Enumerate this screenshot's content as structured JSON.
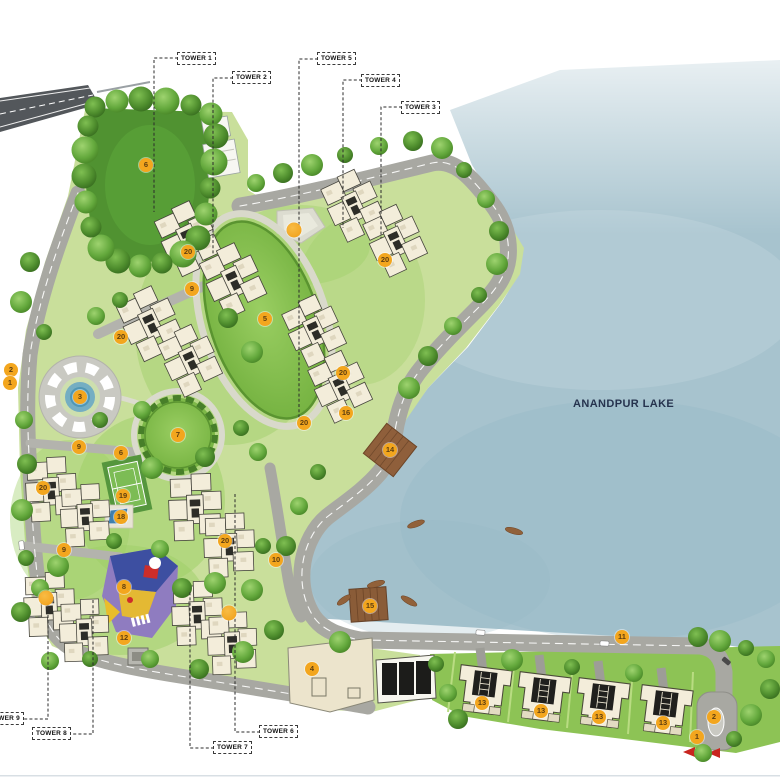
{
  "lake": {
    "name": "ANANDPUR LAKE"
  },
  "tower_labels": [
    {
      "label": "TOWER 1",
      "x": 177,
      "y": 52,
      "leader": [
        [
          178,
          58
        ],
        [
          154,
          58
        ],
        [
          154,
          212
        ]
      ]
    },
    {
      "label": "TOWER 2",
      "x": 232,
      "y": 71,
      "leader": [
        [
          233,
          78
        ],
        [
          213,
          78
        ],
        [
          213,
          255
        ]
      ]
    },
    {
      "label": "TOWER 5",
      "x": 317,
      "y": 52,
      "leader": [
        [
          318,
          59
        ],
        [
          299,
          59
        ],
        [
          299,
          425
        ]
      ]
    },
    {
      "label": "TOWER 4",
      "x": 361,
      "y": 74,
      "leader": [
        [
          362,
          80
        ],
        [
          343,
          80
        ],
        [
          343,
          228
        ]
      ]
    },
    {
      "label": "TOWER 3",
      "x": 401,
      "y": 101,
      "leader": [
        [
          402,
          107
        ],
        [
          381,
          107
        ],
        [
          381,
          238
        ]
      ]
    },
    {
      "label": "TOWER 9",
      "x": -15,
      "y": 712,
      "leader": [
        [
          19,
          719
        ],
        [
          48,
          719
        ],
        [
          48,
          592
        ]
      ]
    },
    {
      "label": "TOWER 8",
      "x": 32,
      "y": 727,
      "leader": [
        [
          68,
          734
        ],
        [
          93,
          734
        ],
        [
          93,
          600
        ]
      ]
    },
    {
      "label": "TOWER 7",
      "x": 213,
      "y": 741,
      "leader": [
        [
          214,
          748
        ],
        [
          190,
          748
        ],
        [
          190,
          590
        ]
      ]
    },
    {
      "label": "TOWER 6",
      "x": 259,
      "y": 725,
      "leader": [
        [
          260,
          732
        ],
        [
          235,
          732
        ],
        [
          235,
          492
        ]
      ]
    }
  ],
  "markers": [
    {
      "label": "2",
      "x": 11,
      "y": 370
    },
    {
      "label": "1",
      "x": 10,
      "y": 383
    },
    {
      "label": "3",
      "x": 80,
      "y": 397
    },
    {
      "label": "4",
      "x": 312,
      "y": 669
    },
    {
      "label": "5",
      "x": 265,
      "y": 319
    },
    {
      "label": "6",
      "x": 146,
      "y": 165
    },
    {
      "label": "6",
      "x": 121,
      "y": 453
    },
    {
      "label": "7",
      "x": 178,
      "y": 435
    },
    {
      "label": "8",
      "x": 124,
      "y": 587
    },
    {
      "label": "9",
      "x": 192,
      "y": 289
    },
    {
      "label": "9",
      "x": 79,
      "y": 447
    },
    {
      "label": "9",
      "x": 64,
      "y": 550
    },
    {
      "label": "10",
      "x": 276,
      "y": 560
    },
    {
      "label": "11",
      "x": 622,
      "y": 637
    },
    {
      "label": "12",
      "x": 124,
      "y": 638
    },
    {
      "label": "13",
      "x": 482,
      "y": 703
    },
    {
      "label": "13",
      "x": 541,
      "y": 711
    },
    {
      "label": "13",
      "x": 599,
      "y": 717
    },
    {
      "label": "13",
      "x": 663,
      "y": 723
    },
    {
      "label": "14",
      "x": 390,
      "y": 450
    },
    {
      "label": "15",
      "x": 370,
      "y": 606
    },
    {
      "label": "16",
      "x": 346,
      "y": 413
    },
    {
      "label": "18",
      "x": 121,
      "y": 517
    },
    {
      "label": "19",
      "x": 123,
      "y": 496
    },
    {
      "label": "20",
      "x": 188,
      "y": 252
    },
    {
      "label": "20",
      "x": 385,
      "y": 260
    },
    {
      "label": "20",
      "x": 121,
      "y": 337
    },
    {
      "label": "20",
      "x": 343,
      "y": 373
    },
    {
      "label": "20",
      "x": 304,
      "y": 423
    },
    {
      "label": "20",
      "x": 225,
      "y": 541
    },
    {
      "label": "20",
      "x": 43,
      "y": 488
    },
    {
      "label": "2",
      "x": 714,
      "y": 717
    },
    {
      "label": "1",
      "x": 697,
      "y": 737
    }
  ],
  "feature_dots": [
    {
      "x": 294,
      "y": 230
    },
    {
      "x": 229,
      "y": 613
    },
    {
      "x": 46,
      "y": 598
    }
  ],
  "colors": {
    "marker_bg": "#F3A61E",
    "marker_text": "#5E3E10",
    "lake": "#A7C3CE",
    "road": "#A8A8A2",
    "dark_road": "#53575B",
    "land": "#C9DF9B",
    "park": "#509231",
    "building": "#F3EDDA",
    "deck": "#8F5F3B",
    "arrow_red": "#C8251F",
    "label_text": "#111111",
    "lake_label_text": "#26334E"
  }
}
